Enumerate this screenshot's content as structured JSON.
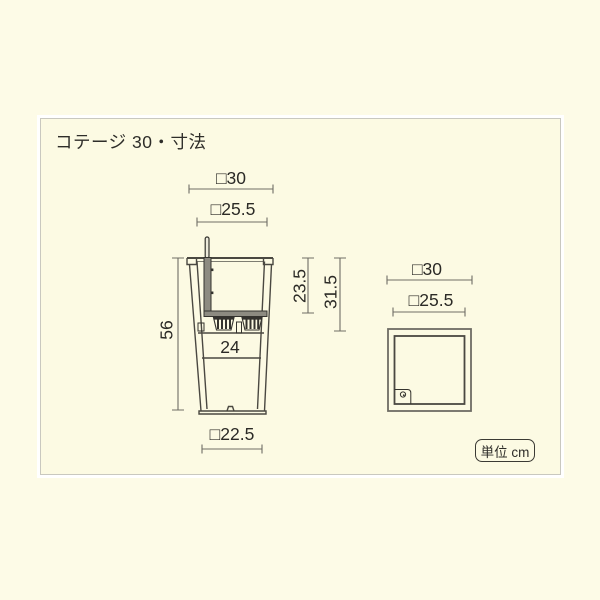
{
  "title": "コテージ 30・寸法",
  "unit_label": "単位 cm",
  "side_view": {
    "top_outer_width": "□30",
    "top_inner_width": "□25.5",
    "total_height": "56",
    "inner_depth": "23.5",
    "liner_depth": "31.5",
    "mid_inner_width": "24",
    "bottom_width": "□22.5"
  },
  "top_view": {
    "outer_width": "□30",
    "inner_width": "□25.5"
  },
  "colors": {
    "background": "#fdfbe7",
    "panel_background": "#fcfae3",
    "panel_border": "#c9c8bf",
    "outline": "#4a4841",
    "dimension_line": "#6f6d65",
    "text": "#2b2a26",
    "gray_fill": "#8d8b81"
  }
}
